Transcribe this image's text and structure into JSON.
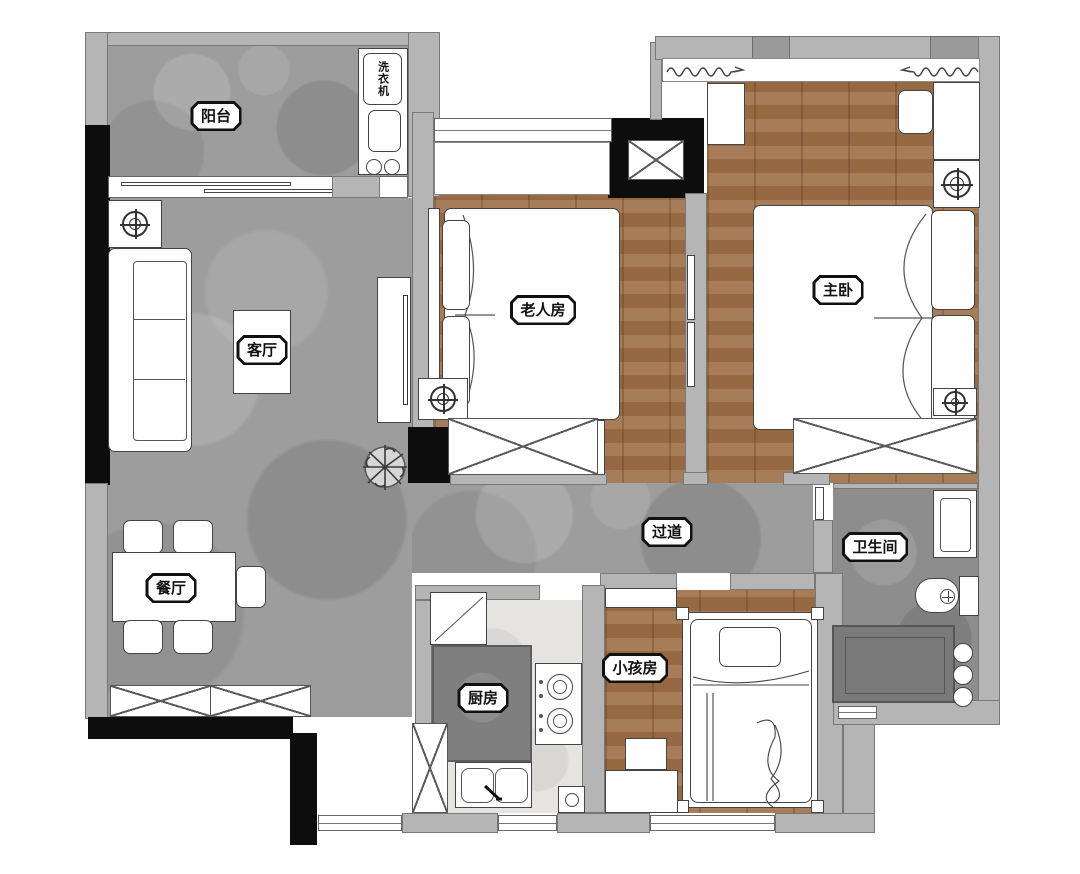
{
  "plan": {
    "title": "two-bed-plus-two apartment floor plan",
    "rooms": [
      {
        "id": "balcony",
        "label": "阳台"
      },
      {
        "id": "living-room",
        "label": "客厅"
      },
      {
        "id": "dining-room",
        "label": "餐厅"
      },
      {
        "id": "elder-bedroom",
        "label": "老人房"
      },
      {
        "id": "master-bedroom",
        "label": "主卧"
      },
      {
        "id": "corridor",
        "label": "过道"
      },
      {
        "id": "bathroom",
        "label": "卫生间"
      },
      {
        "id": "kitchen",
        "label": "厨房"
      },
      {
        "id": "kids-bedroom",
        "label": "小孩房"
      }
    ],
    "appliances": {
      "washer": "洗衣机"
    },
    "colors": {
      "stone_floor": "#9d9d9d",
      "stone_floor_dark": "#8d8d8d",
      "wood_floor": "#a0714a",
      "kitchen_floor": "#e6e4e1",
      "wall": "#b5b5b5",
      "structural_column": "#0d0d0d",
      "counter": "#7f7f7f",
      "furniture_fill": "#fefefe",
      "outline": "#444444"
    }
  }
}
